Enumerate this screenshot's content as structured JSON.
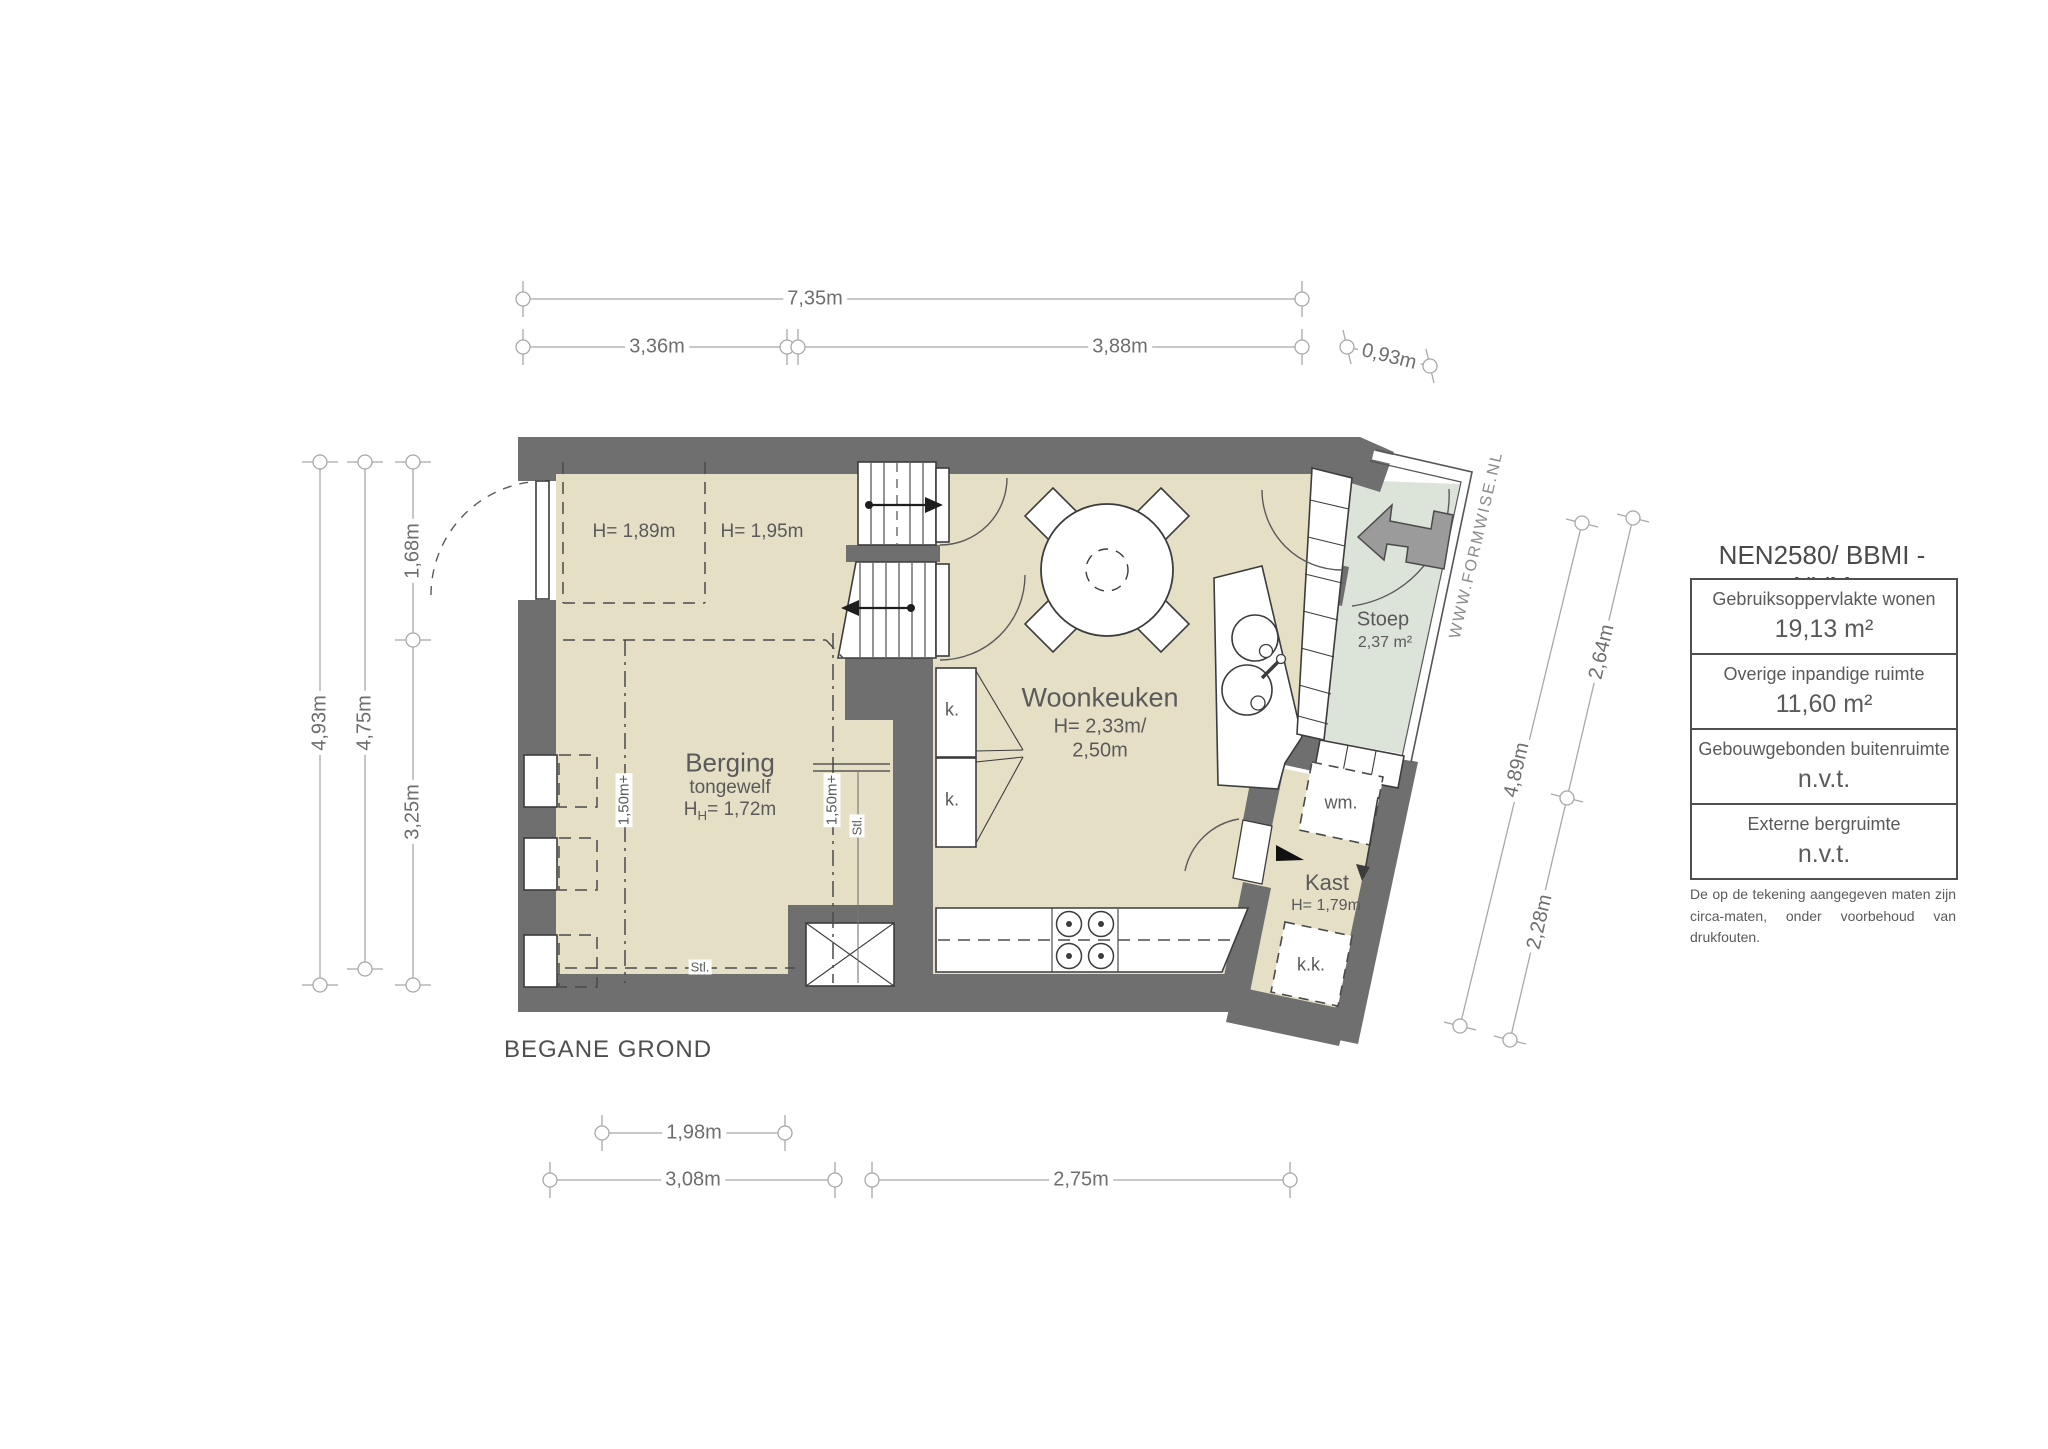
{
  "title": "BEGANE GROND",
  "watermark": "WWW.FORMWISE.NL",
  "rooms": {
    "berging": {
      "name": "Berging",
      "sub": "tongewelf",
      "h_main": "H",
      "h_sub": "H",
      "h_rest": "= 1,72m"
    },
    "woonkeuken": {
      "name": "Woonkeuken",
      "h1": "H= 2,33m/",
      "h2": "2,50m"
    },
    "kast": {
      "name": "Kast",
      "h": "H= 1,79m"
    },
    "stoep": {
      "name": "Stoep",
      "area": "2,37 m²"
    }
  },
  "labels": {
    "h_zone_left": "H= 1,89m",
    "h_zone_right": "H= 1,95m",
    "cabinet1": "k.",
    "cabinet2": "k.",
    "washing_machine": "wm.",
    "fridge": "k.k.",
    "stl_vertical": "Stl.",
    "stl_horizontal": "Stl.",
    "level_line1": "1,50m+",
    "level_line2": "1,50m+"
  },
  "dimensions": {
    "top_total": "7,35m",
    "top_left": "3,36m",
    "top_right": "3,88m",
    "top_slant": "0,93m",
    "left_outer": "4,93m",
    "left_inner": "4,75m",
    "left_top": "1,68m",
    "left_bottom": "3,25m",
    "right_top": "2,64m",
    "right_total": "4,89m",
    "right_bottom": "2,28m",
    "bottom_inner": "1,98m",
    "bottom_left": "3,08m",
    "bottom_right": "2,75m"
  },
  "legend": {
    "title": "NEN2580/ BBMI - NVM",
    "rows": [
      {
        "label": "Gebruiksoppervlakte wonen",
        "value": "19,13 m²"
      },
      {
        "label": "Overige inpandige ruimte",
        "value": "11,60 m²"
      },
      {
        "label": "Gebouwgebonden buitenruimte",
        "value": "n.v.t."
      },
      {
        "label": "Externe bergruimte",
        "value": "n.v.t."
      }
    ],
    "footnote": "De op de tekening aangegeven maten zijn circa-maten, onder voorbehoud van drukfouten."
  },
  "colors": {
    "wall": "#6f6f6f",
    "floor": "#e5dfc6",
    "stoep": "#dce3d8",
    "dimline": "#a8a8a8",
    "text": "#5a5a5a"
  }
}
